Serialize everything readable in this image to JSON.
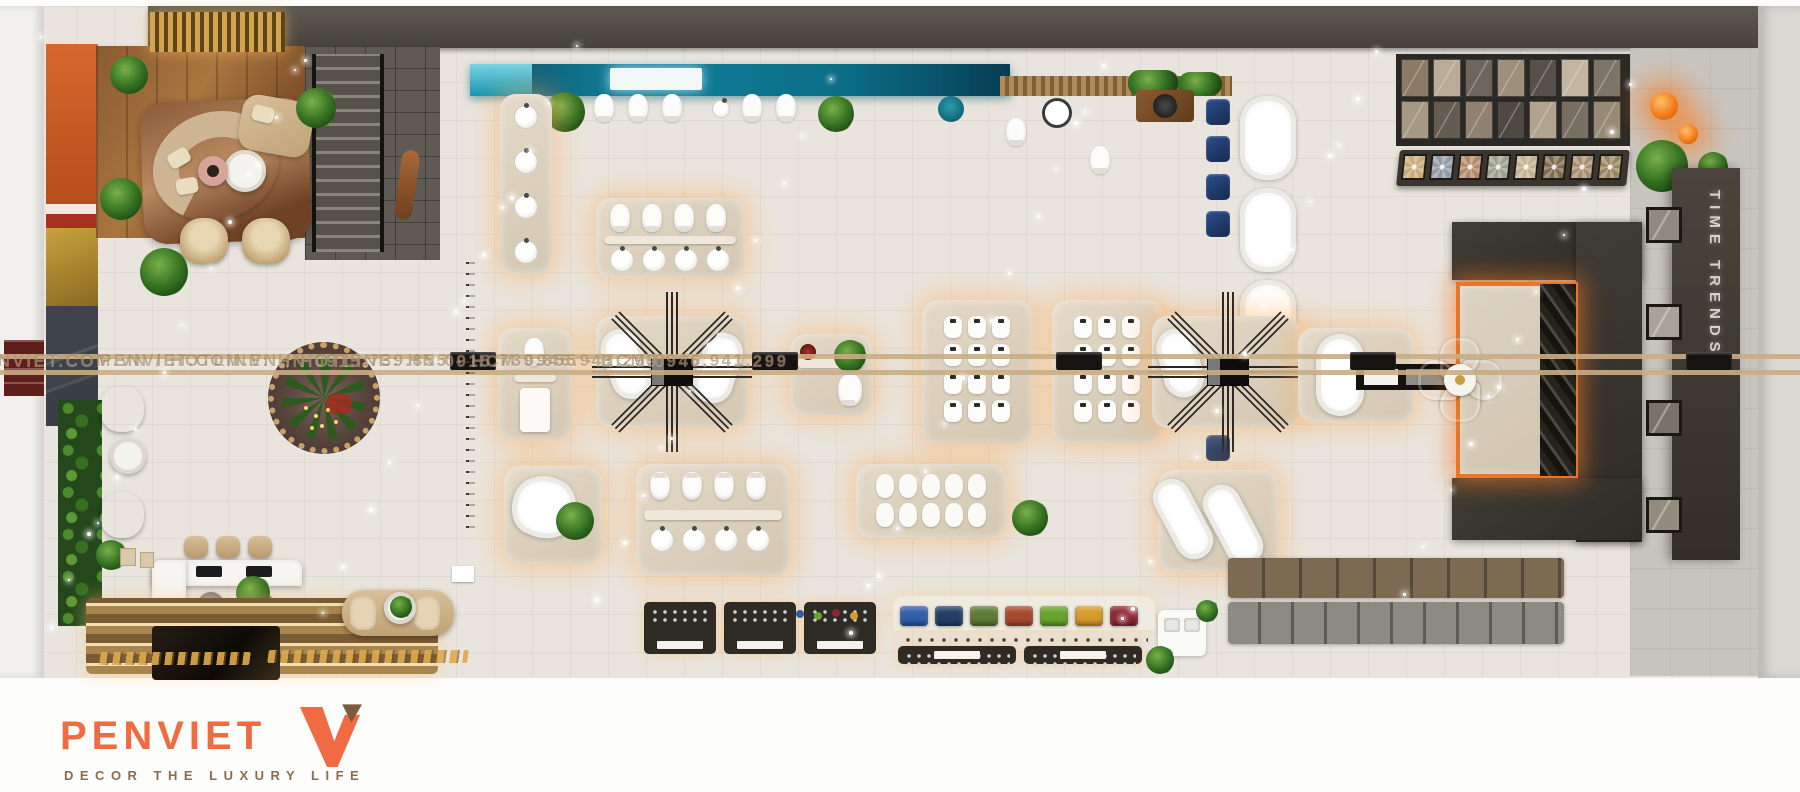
{
  "watermark": {
    "text": "PENVIET.COM.VN / HOTLINE: HN 0915.739.855 - HCM 0946.941.299"
  },
  "signs": {
    "tile_zone_sign": "TIME TRENDS"
  },
  "footer_logo": {
    "brand": "PENVIET",
    "tagline": "DECOR THE LUXURY LIFE",
    "brand_color": "#F06A42",
    "tagline_color": "#8A6E4E",
    "mark_colors": {
      "v": "#F06A42",
      "triangle": "#7B5C3A"
    }
  },
  "palette": {
    "floor": "#E9E5DE",
    "top_wall": "#55514B",
    "teal_feature_wall": "#12809B",
    "charcoal_tile_unit": "#3A3732",
    "amber_glow": "#FFB05C",
    "rail_tan": "#C9AD85",
    "navy_fixture": "#1E3A6E",
    "plant_green": "#2F6A1F",
    "orange_accent_wall": "#C85A24"
  },
  "colored_basins": [
    "#2F5FA6",
    "#224066",
    "#5E7B33",
    "#A8492E",
    "#66A42C",
    "#D89B2A",
    "#8D2332"
  ],
  "pattern_tiles": [
    "#C9A977",
    "#8E9AA6",
    "#B2876A",
    "#9AA08B",
    "#C2B290",
    "#7E6A4E",
    "#A78C6F",
    "#99855F"
  ],
  "marble_wall": [
    "#8A7A66",
    "#B8AB97",
    "#6E665C",
    "#9C8F7C",
    "#55504A",
    "#C2B6A2",
    "#7D7468",
    "#A59884",
    "#635C52",
    "#8F8273",
    "#4E4943",
    "#B0A48F",
    "#786F63",
    "#968A76"
  ],
  "trend_tiles": [
    "#8F8A80",
    "#A8A298",
    "#7A7268",
    "#938B7E"
  ]
}
